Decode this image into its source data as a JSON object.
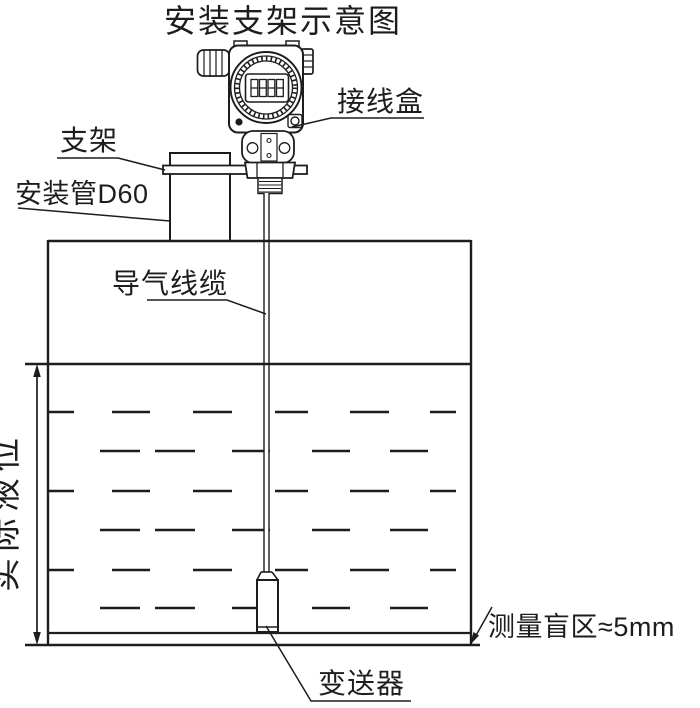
{
  "title": "安装支架示意图",
  "labels": {
    "junction_box": "接线盒",
    "bracket": "支架",
    "mounting_pipe": "安装管D60",
    "air_cable": "导气线缆",
    "actual_level": "实际液位",
    "blind_zone": "测量盲区≈5mm",
    "transmitter": "变送器"
  },
  "device": {
    "lcd_display": "8888"
  },
  "colors": {
    "line": "#1d1d1d",
    "background": "#ffffff"
  }
}
